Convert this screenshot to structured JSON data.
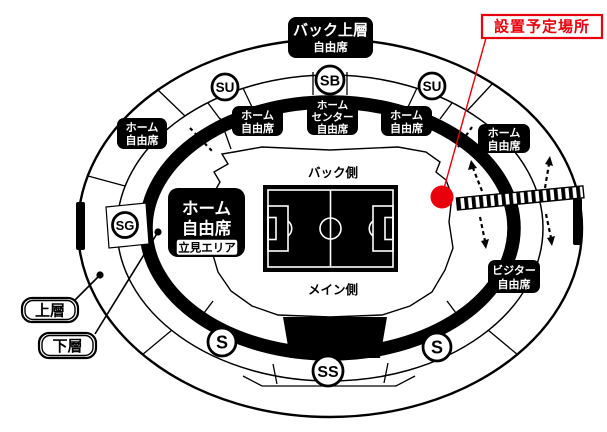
{
  "annotation": {
    "installation_label": "設置予定場所"
  },
  "legend": {
    "upper_tier": "上層",
    "lower_tier": "下層"
  },
  "field": {
    "back_side": "バック側",
    "main_side": "メイン側"
  },
  "gates": {
    "su_left": "SU",
    "sb": "SB",
    "su_right": "SU",
    "sg": "SG",
    "s_left": "S",
    "ss": "SS",
    "s_right": "S"
  },
  "sections": {
    "back_upper": {
      "line1": "バック上層",
      "line2": "自由席"
    },
    "home_outer_left": {
      "line1": "ホーム",
      "line2": "自由席"
    },
    "home_inner_left": {
      "line1": "ホーム",
      "line2": "自由席"
    },
    "home_center": {
      "line1": "ホーム",
      "line2": "センター",
      "line3": "自由席"
    },
    "home_inner_right": {
      "line1": "ホーム",
      "line2": "自由席"
    },
    "home_outer_right": {
      "line1": "ホーム",
      "line2": "自由席"
    },
    "home_main": {
      "line1": "ホーム",
      "line2": "自由席",
      "standing_area": "立見エリア"
    },
    "visitor": {
      "line1": "ビジター",
      "line2": "自由席"
    }
  },
  "colors": {
    "accent_red": "#e8000d",
    "black": "#000000",
    "white": "#ffffff"
  }
}
